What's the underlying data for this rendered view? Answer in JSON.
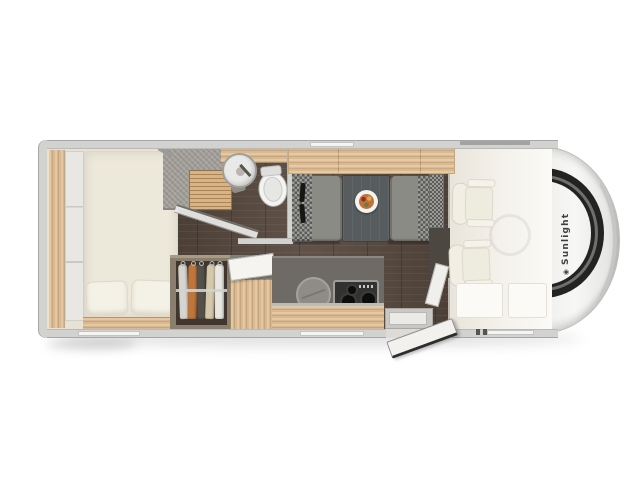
{
  "brand": {
    "name": "Sunlight",
    "symbol": "◉"
  },
  "inventory": {
    "rear_bedroom": [
      "double-bed",
      "pillow",
      "pillow",
      "side-shelf",
      "headboard-panels"
    ],
    "bathroom": [
      "shower-tray",
      "shower-duckboard",
      "glass-door",
      "washbasin",
      "toilet",
      "vanity-counter"
    ],
    "wardrobe": {
      "garments": 5
    },
    "kitchen": [
      "fridge-cabinet",
      "open-flap",
      "round-sink",
      "hob-3-burner",
      "drawer-unit"
    ],
    "dinette": [
      "overhead-locker",
      "bench-with-2-seatbelts",
      "table-with-plate",
      "bench"
    ],
    "cab": [
      "swivel-seat",
      "swivel-seat",
      "floor-mat",
      "floor-mat",
      "steering-wheel",
      "windshield"
    ],
    "entry": [
      "open-door",
      "step",
      "threshold"
    ]
  },
  "colors": {
    "wall": "#d2d2d0",
    "wall_edge": "#a6a6a4",
    "floor_dark": "#57483e",
    "wood": "#dcb98c",
    "bed": "#ece8da",
    "pillow": "#f4f1e6",
    "panel": "#e8e7e3",
    "shower": "#a5a19b",
    "glass": "#ececea",
    "sink": "#e9e9e7",
    "toilet": "#f3f3f1",
    "bench": "#8b8b86",
    "checker_dark": "#5a5a58",
    "checker_light": "#9c9c98",
    "table": "#575d5f",
    "belt": "#161614",
    "counter": "#6e6b67",
    "hob": "#323230",
    "burner": "#0d0d0b",
    "kitchen_sink": "#8f8c87",
    "cabinet_gray": "#83807b",
    "flap": "#f5f4f1",
    "step": "#c9c8c4",
    "door": "#f2f1ed",
    "door_edge": "#2e2e2c",
    "cab_floor": "#f3f0e9",
    "seat": "#f1eee3",
    "mat": "#fbfaf6",
    "front_body": "#f7f7f5",
    "windshield": "#232321",
    "wardrobe_box": "#8a7f6f",
    "wardrobe_interior": "#40362d",
    "garment1": "#d7d5cf",
    "garment2": "#c0763a",
    "garment3": "#54504a",
    "garment4": "#d6c9ab",
    "garment5": "#e9e7e1",
    "plate": "#f4f3ef",
    "food": "#c2703c",
    "window": "#f4f4f2",
    "brand_text": "#3f3f3d"
  }
}
